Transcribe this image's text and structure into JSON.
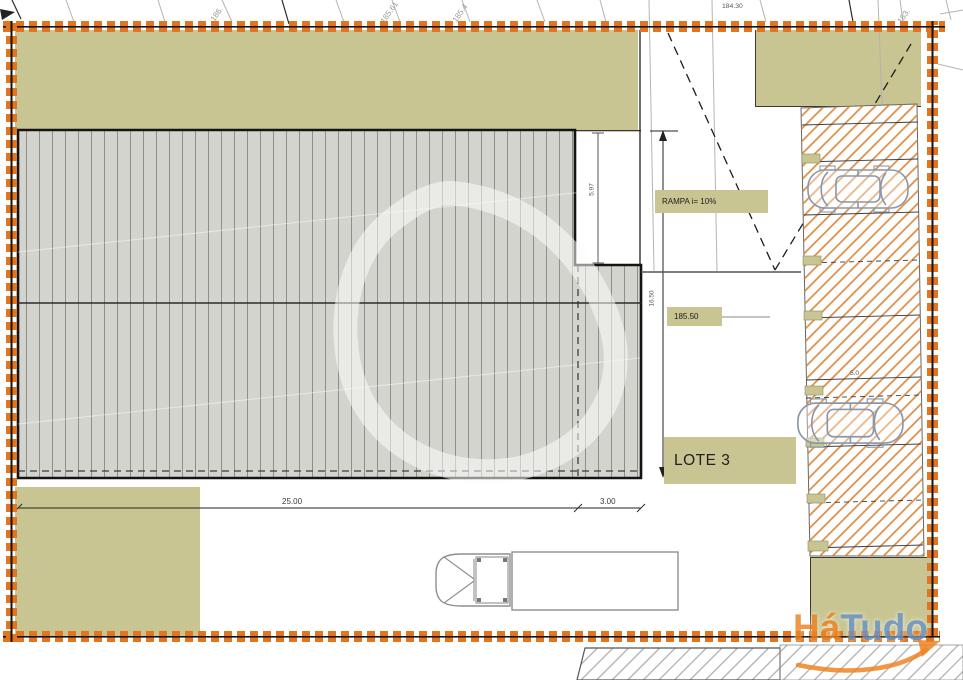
{
  "plan_title": "Site plan lot drawing",
  "labels": {
    "lot": "LOTE 3",
    "ramp": "RAMPA i= 10%",
    "level": "185.50",
    "dim_width": "25.00",
    "dim_offset": "3.00",
    "dim_depth": "5.97",
    "dim_front": "16.50",
    "dim_bay": "5.0",
    "elev_a": "186.",
    "elev_b": "185.61",
    "elev_c": "185.4",
    "elev_d": "184.30",
    "elev_e": "183."
  },
  "watermark": {
    "prefix": "Há",
    "suffix": "Tudo"
  },
  "colors": {
    "lot_border_orange": "#e2751d",
    "zone_green": "#c8c593",
    "parking_hatch_orange": "#d67e2c",
    "building_gray": "#d4d4ce",
    "logo_orange": "#ee8422",
    "logo_blue": "#6b93c4"
  }
}
